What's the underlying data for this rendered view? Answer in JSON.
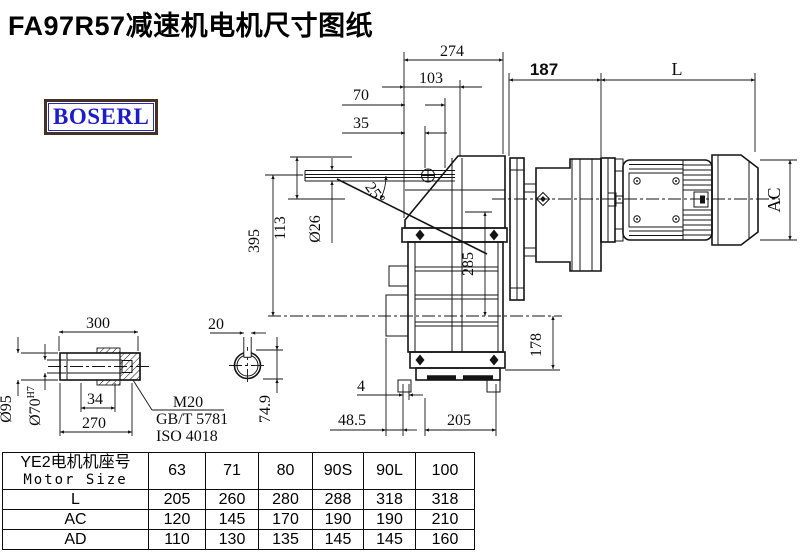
{
  "title": "FA97R57减速机电机尺寸图纸",
  "logo_text": "BOSERL",
  "drawing": {
    "dims": {
      "w274": "274",
      "w103": "103",
      "w70": "70",
      "w35": "35",
      "w187": "187",
      "wL": "L",
      "h395": "395",
      "h113": "113",
      "dia26": "Ø26",
      "angle25": "25°",
      "h285": "285",
      "hAC": "AC",
      "h178": "178",
      "b4": "4",
      "b48_5": "48.5",
      "b205": "205"
    },
    "shaft": {
      "l300": "300",
      "l270": "270",
      "l34": "34",
      "dia95": "Ø95",
      "dia70": "Ø70",
      "tol": "H7",
      "thread": "M20",
      "gb": "GB/T 5781",
      "iso": "ISO 4018",
      "w20": "20",
      "k74_9": "74.9"
    }
  },
  "table": {
    "header_label_cn": "YE2电机机座号",
    "header_label_en": "Motor Size",
    "columns": [
      "63",
      "71",
      "80",
      "90S",
      "90L",
      "100"
    ],
    "rows": [
      {
        "label": "L",
        "values": [
          "205",
          "260",
          "280",
          "288",
          "318",
          "318"
        ]
      },
      {
        "label": "AC",
        "values": [
          "120",
          "145",
          "170",
          "190",
          "190",
          "210"
        ]
      },
      {
        "label": "AD",
        "values": [
          "110",
          "130",
          "135",
          "145",
          "145",
          "160"
        ]
      }
    ]
  },
  "colors": {
    "line": "#141414",
    "logo_text": "#1c1ccc",
    "logo_border": "#453227"
  }
}
